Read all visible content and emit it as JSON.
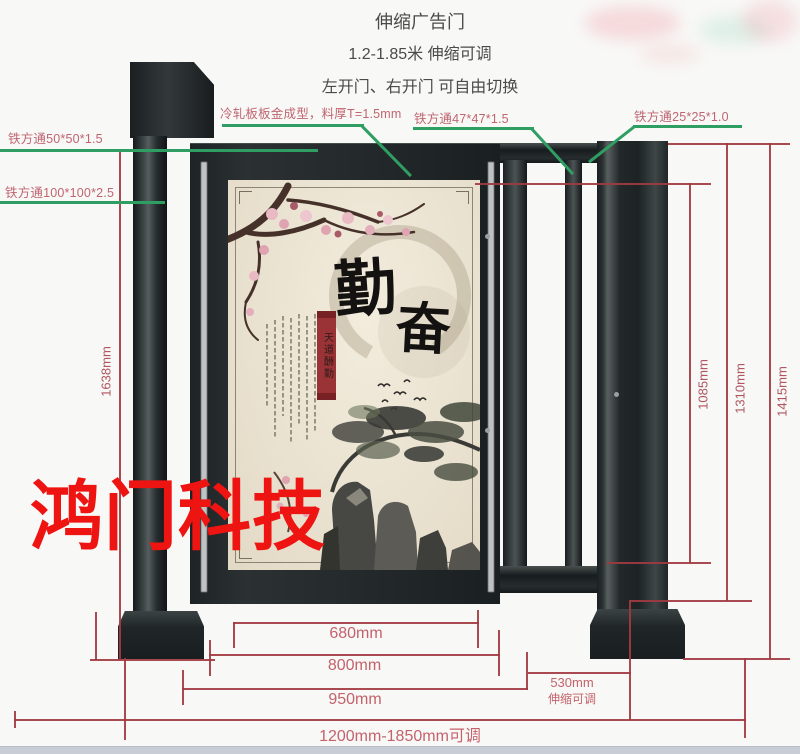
{
  "header": {
    "line1": "伸缩广告门",
    "line2": "1.2-1.85米 伸缩可调",
    "line3": "左开门、右开门 可自由切换"
  },
  "material_labels": {
    "square_tube_50": "铁方通50*50*1.5",
    "square_tube_100": "铁方通100*100*2.5",
    "cold_rolled_plate": "冷轧板板金成型，料厚T=1.5mm",
    "square_tube_47": "铁方通47*47*1.5",
    "square_tube_25": "铁方通25*25*1.0"
  },
  "dimensions": {
    "left_total_height": "1638mm",
    "rail_section_height": "1085mm",
    "pole_height": "1310mm",
    "overall_height": "1415mm",
    "panel_width": "680mm",
    "door_width": "800mm",
    "door_overall_width": "950mm",
    "telescopic_width": "530mm",
    "telescopic_note": "伸缩可调",
    "overall_width_range": "1200mm-1850mm可调"
  },
  "poster": {
    "calligraphy_top": "勤",
    "calligraphy_bottom": "奋",
    "seal_banner": "天道酬勤"
  },
  "watermark": {
    "text": "鸿门科技"
  },
  "colors": {
    "leader_green": "#2f9e63",
    "dimension_red": "#a23a41",
    "label_pink": "#bf6570",
    "frame_dark": "#24292b",
    "poster_cream": "#eae2d1",
    "watermark_red": "#ed1412"
  }
}
